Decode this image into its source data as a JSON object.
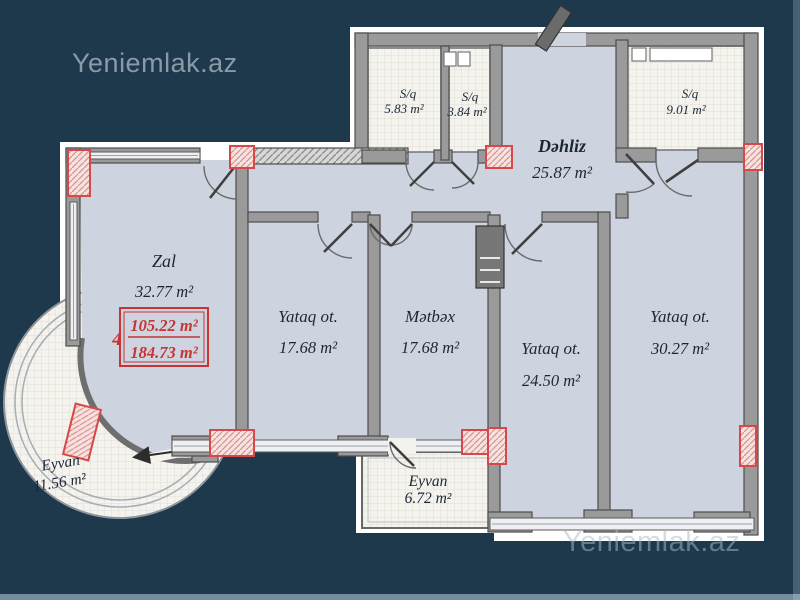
{
  "watermarks": {
    "top_left": "Yeniemlak.az",
    "bottom_right": "Yeniemlak.az"
  },
  "rooms": [
    {
      "id": "zal",
      "name": "Zal",
      "area": "32.77 m²"
    },
    {
      "id": "yataq-1",
      "name": "Yataq ot.",
      "area": "17.68 m²"
    },
    {
      "id": "metbex",
      "name": "Mətbəx",
      "area": "17.68 m²"
    },
    {
      "id": "yataq-2",
      "name": "Yataq ot.",
      "area": "24.50 m²"
    },
    {
      "id": "yataq-3",
      "name": "Yataq ot.",
      "area": "30.27 m²"
    },
    {
      "id": "dehliz",
      "name": "Dəhliz",
      "area": "25.87 m²"
    },
    {
      "id": "sq-1",
      "name": "S/q",
      "area": "5.83 m²"
    },
    {
      "id": "sq-2",
      "name": "S/q",
      "area": "3.84 m²"
    },
    {
      "id": "sq-3",
      "name": "S/q",
      "area": "9.01 m²"
    },
    {
      "id": "eyvan-1",
      "name": "Eyvan",
      "area": "11.56 m²"
    },
    {
      "id": "eyvan-2",
      "name": "Eyvan",
      "area": "6.72 m²"
    }
  ],
  "stamp": {
    "storey": "4",
    "value_top": "105.22 m²",
    "value_bottom": "184.73 m²"
  },
  "colors": {
    "background": "#1d394b",
    "room_fill": "#cdd4df",
    "wall": "#9a9a9a",
    "marker_red": "#d84848",
    "stamp_red": "#c63434",
    "label": "#1b2735",
    "watermark": "#8a9aa9"
  }
}
